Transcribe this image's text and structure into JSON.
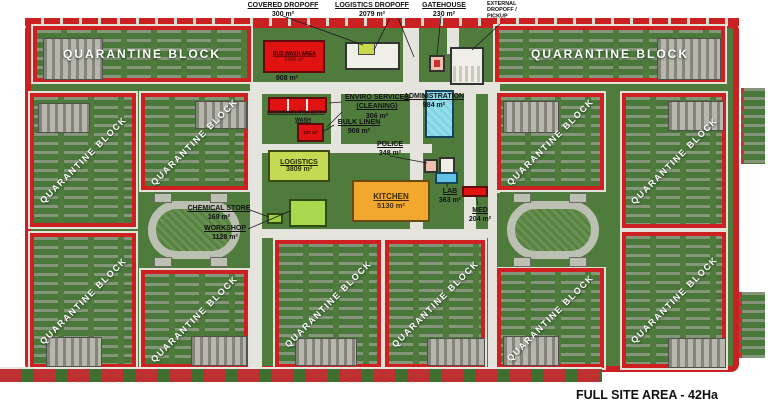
{
  "labels": {
    "quarantine_block": "QUARANTINE BLOCK",
    "full_site_area": "FULL SITE AREA - 42Ha"
  },
  "facilities": {
    "covered_dropoff": {
      "name": "COVERED DROPOFF",
      "area": "300 m²"
    },
    "logistics_dropoff": {
      "name": "LOGISTICS DROPOFF",
      "area": "2079 m²"
    },
    "gatehouse": {
      "name": "GATEHOUSE",
      "area": "230 m²"
    },
    "external_dropoff": {
      "name": "EXTERNAL DROPOFF / PICKUP"
    },
    "bus_wash": {
      "name": "BUS WASH AREA",
      "area": "3480 m²",
      "yard_area": "908 m²"
    },
    "decontamination_entry": {
      "name": "DECONTAMINATION ENTRY"
    },
    "wash": {
      "name": "WASH",
      "area": "227 m²"
    },
    "enviro_services": {
      "name": "ENVIRO SERVICES (CLEANING)",
      "area": "306 m²"
    },
    "bulk_linen": {
      "name": "BULK LINEN",
      "area": "908 m²"
    },
    "administration": {
      "name": "ADMINISTRATION",
      "area": "984 m²"
    },
    "police": {
      "name": "POLICE",
      "area": "348 m²"
    },
    "logistics": {
      "name": "LOGISTICS",
      "area": "3809 m²"
    },
    "kitchen": {
      "name": "KITCHEN",
      "area": "5130 m²"
    },
    "lab": {
      "name": "LAB",
      "area": "363 m²"
    },
    "med": {
      "name": "MED",
      "area": "204 m²"
    },
    "chemical_store": {
      "name": "CHEMICAL STORE",
      "area": "168 m²"
    },
    "workshop": {
      "name": "WORKSHOP",
      "area": "1128 m²"
    }
  },
  "colors": {
    "boundary_red": "#c92121",
    "site_green": "#4f7c3d",
    "road_gray": "#e4e4dc",
    "building_red": "#e01212",
    "admin_blue": "#7fd4e6",
    "lab_blue": "#62c4e4",
    "logistics_green": "#c3da52",
    "kitchen_orange": "#f2a72e",
    "gatehouse_pink": "#eec0ae",
    "barracks_gray": "#b6b6ac"
  }
}
